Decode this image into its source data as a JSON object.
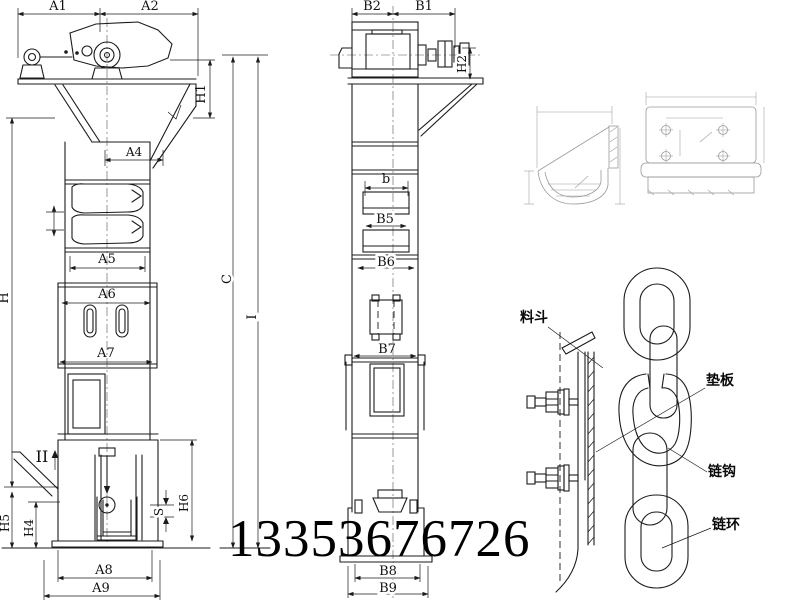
{
  "phone": "13353676726",
  "front": {
    "a1": "A1",
    "a2": "A2",
    "h1": "H1",
    "a4": "A4",
    "a5": "A5",
    "a6": "A6",
    "a7": "A7",
    "h": "H",
    "section": "II",
    "h5": "H5",
    "h4": "H4",
    "h6": "H6",
    "s": "S",
    "a8": "A8",
    "a9": "A9"
  },
  "side": {
    "b2": "B2",
    "b1": "B1",
    "h2": "H2",
    "b": "b",
    "b5": "B5",
    "b6": "B6",
    "b7": "B7",
    "c": "C",
    "i": "I",
    "b8": "B8",
    "b9": "B9"
  },
  "detail": {
    "bucket": "料斗",
    "pad": "垫板",
    "hook": "链钩",
    "link": "链环"
  },
  "colors": {
    "line": "#1b1b1b",
    "faint": "#9a9a9a",
    "background": "#ffffff"
  }
}
